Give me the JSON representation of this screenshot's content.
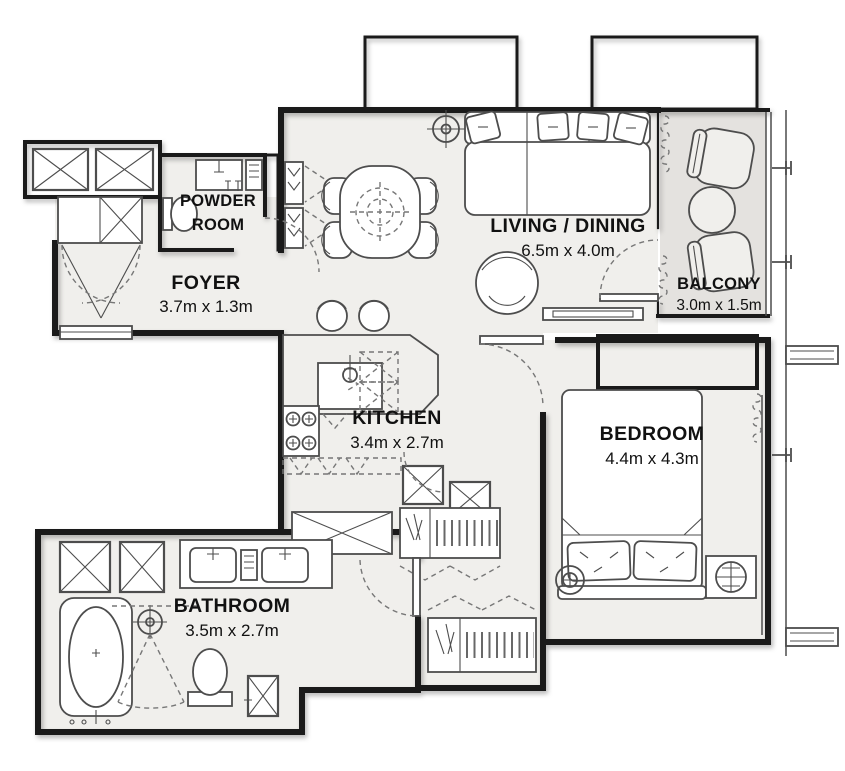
{
  "rooms": {
    "powder_room": {
      "name_line1": "POWDER",
      "name_line2": "ROOM"
    },
    "foyer": {
      "name": "FOYER",
      "dims": "3.7m x 1.3m"
    },
    "living_dining": {
      "name": "LIVING / DINING",
      "dims": "6.5m x 4.0m"
    },
    "balcony": {
      "name": "BALCONY",
      "dims": "3.0m x 1.5m"
    },
    "kitchen": {
      "name": "KITCHEN",
      "dims": "3.4m x 2.7m"
    },
    "bedroom": {
      "name": "BEDROOM",
      "dims": "4.4m x 4.3m"
    },
    "bathroom": {
      "name": "BATHROOM",
      "dims": "3.5m x 2.7m"
    }
  },
  "colors": {
    "floor": "#f0efec",
    "balcony_floor": "#e4e2df",
    "wall": "#1a1a1a",
    "furniture_line": "#4d4d4d",
    "dashed_line": "#777777",
    "label_text": "#111111",
    "background": "#ffffff"
  }
}
